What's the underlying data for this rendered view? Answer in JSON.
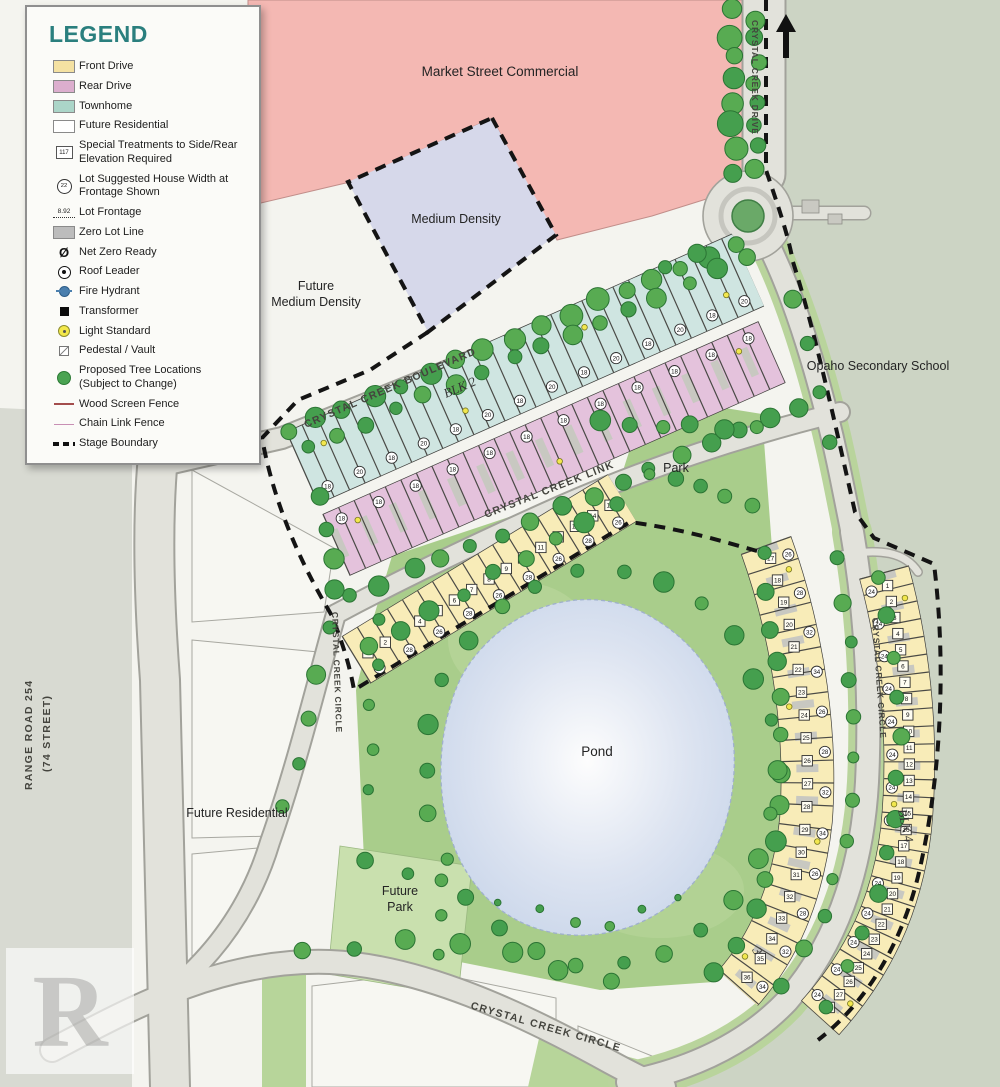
{
  "legend": {
    "title": "LEGEND",
    "items": [
      {
        "l1": "Front Drive"
      },
      {
        "l1": "Rear Drive"
      },
      {
        "l1": "Townhome"
      },
      {
        "l1": "Future Residential"
      },
      {
        "glyph": "117",
        "l1": "Special Treatments to Side/Rear",
        "l2": "Elevation Required"
      },
      {
        "glyph": "22",
        "l1": "Lot Suggested House Width at",
        "l2": "Frontage Shown"
      },
      {
        "glyph": "8.92",
        "l1": "Lot Frontage"
      },
      {
        "l1": "Zero Lot Line"
      },
      {
        "glyph": "Ø",
        "l1": "Net Zero Ready"
      },
      {
        "l1": "Roof Leader"
      },
      {
        "l1": "Fire Hydrant"
      },
      {
        "l1": "Transformer"
      },
      {
        "l1": "Light Standard"
      },
      {
        "l1": "Pedestal / Vault"
      },
      {
        "l1": "Proposed Tree Locations",
        "l2": "(Subject to Change)"
      },
      {
        "l1": "Wood Screen Fence"
      },
      {
        "l1": "Chain Link Fence"
      },
      {
        "l1": "Stage Boundary"
      }
    ]
  },
  "map": {
    "labels": {
      "market": "Market Street Commercial",
      "medium_density": "Medium Density",
      "future_medium_1": "Future",
      "future_medium_2": "Medium Density",
      "school": "Opaho Secondary School",
      "highway_1": "TO HIGHWAY 39",
      "highway_2": "(50 AVENUE)",
      "park": "Park",
      "pond": "Pond",
      "future_park_1": "Future",
      "future_park_2": "Park",
      "future_residential": "Future Residential"
    },
    "streets": {
      "drive": "CRYSTAL CREEK DRIVE",
      "boulevard": "CRYSTAL CREEK BOULEVARD",
      "link": "CRYSTAL CREEK LINK",
      "circle_left": "CRYSTAL CREEK CIRCLE",
      "circle_right": "CRYSTAL CREEK CIRCLE",
      "circle_bottom": "CRYSTAL CREEK CIRCLE",
      "range_1": "RANGE ROAD 254",
      "range_2": "(74 STREET)"
    },
    "blocks": {
      "blk2": {
        "label": "BLK 2",
        "type": "Townhome",
        "lots": "1–40",
        "widths": [
          "18",
          "20"
        ]
      },
      "rear": {
        "type": "Rear Drive",
        "lots": "41–73",
        "widths": [
          "18"
        ]
      },
      "link": {
        "type": "Front Drive",
        "lots_from": 1,
        "lots_to": 15,
        "widths": [
          "26",
          "28"
        ]
      },
      "warc": {
        "type": "Front Drive",
        "lots_from": 17,
        "lots_to": 36,
        "widths": [
          "26",
          "28",
          "32",
          "34"
        ]
      },
      "blk4": {
        "label": "BLK 4",
        "type": "Front Drive",
        "lots_from": 1,
        "lots_to": 28,
        "widths": [
          "24"
        ]
      },
      "blk3": {
        "label": "3"
      }
    },
    "watermark": {
      "letter": "R",
      "text": "REALTOR®"
    },
    "colors": {
      "commercial": "#f4b8b3",
      "medium_density": "#d6d8ea",
      "townhome": "#cfe5e1",
      "rear_drive": "#e4c2dc",
      "front_drive": "#f8ecb8",
      "park": "#a9cd8b",
      "pond": "#c7d4e9",
      "school_bg": "#ccd4c4",
      "road": "#e2e2db",
      "legend_title": "#2a7f7e"
    }
  }
}
